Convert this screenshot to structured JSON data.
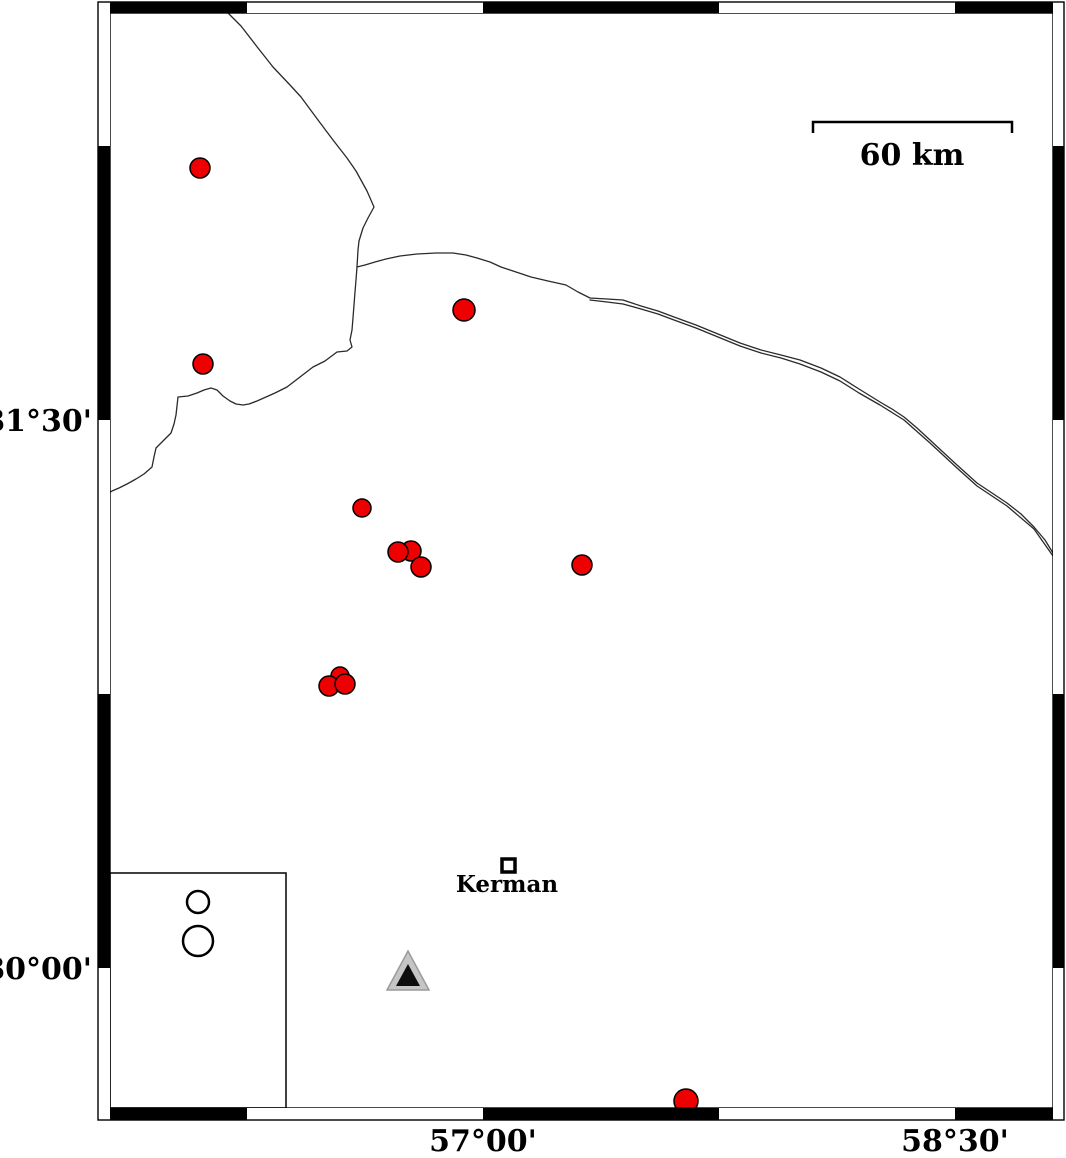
{
  "figure": {
    "type": "seismicity-map",
    "width": 1066,
    "height": 1158
  },
  "colors": {
    "epicenter_fill": "#ee0000",
    "marker_stroke": "#000000",
    "line": "#2a2a2a",
    "frame": "#000000",
    "triangle_fill": "#c5c5c5",
    "triangle_stroke": "#9a9a9a",
    "triangle_inner": "#0d0d0d",
    "background": "#ffffff"
  },
  "axis": {
    "lat_ticks": [
      {
        "label": "31°30'",
        "x": 92,
        "y": 431
      },
      {
        "label": "30°00'",
        "x": 92,
        "y": 979
      }
    ],
    "lon_ticks": [
      {
        "label": "57°00'",
        "x": 483,
        "y": 1151
      },
      {
        "label": "58°30'",
        "x": 955,
        "y": 1151
      }
    ]
  },
  "frame": {
    "outer": {
      "x": 98,
      "y": 2,
      "w": 966,
      "h": 1118
    },
    "inner": {
      "x": 110,
      "y": 13,
      "w": 943,
      "h": 1095
    },
    "segments": {
      "top": [
        [
          110,
          247
        ],
        [
          483,
          719
        ],
        [
          955,
          1053
        ]
      ],
      "bottom": [
        [
          110,
          247
        ],
        [
          483,
          719
        ],
        [
          955,
          1053
        ]
      ],
      "left": [
        [
          146,
          420
        ],
        [
          694,
          968
        ]
      ],
      "right": [
        [
          146,
          420
        ],
        [
          694,
          968
        ]
      ]
    }
  },
  "scalebar": {
    "label": "60 km",
    "x1": 813,
    "x2": 1012,
    "y": 122,
    "tick_bottom": 133,
    "label_x": 912,
    "label_y": 165
  },
  "city": {
    "name": "Kerman",
    "square": {
      "x": 502,
      "y": 859,
      "size": 13
    },
    "label_x": 507,
    "label_y": 892
  },
  "station_triangle": {
    "outer_points": "408,951 387,990 429,990",
    "inner_points": "408,964 396,986 420,986"
  },
  "legend": {
    "box": {
      "x": 110,
      "y": 873,
      "w": 176,
      "h": 235
    },
    "circles": [
      {
        "x": 198,
        "y": 902,
        "r": 11
      },
      {
        "x": 198,
        "y": 941,
        "r": 15
      }
    ]
  },
  "earthquakes": [
    {
      "x": 200,
      "y": 168,
      "r": 10
    },
    {
      "x": 203,
      "y": 364,
      "r": 10
    },
    {
      "x": 464,
      "y": 310,
      "r": 11
    },
    {
      "x": 362,
      "y": 508,
      "r": 9
    },
    {
      "x": 411,
      "y": 551,
      "r": 10
    },
    {
      "x": 398,
      "y": 552,
      "r": 10
    },
    {
      "x": 421,
      "y": 567,
      "r": 10
    },
    {
      "x": 582,
      "y": 565,
      "r": 10
    },
    {
      "x": 340,
      "y": 676,
      "r": 9
    },
    {
      "x": 329,
      "y": 686,
      "r": 10
    },
    {
      "x": 345,
      "y": 684,
      "r": 10
    },
    {
      "x": 686,
      "y": 1101,
      "r": 12
    }
  ],
  "map_lines": [
    {
      "name": "boundary-line-north",
      "points": [
        [
          228,
          13
        ],
        [
          241,
          26
        ],
        [
          258,
          48
        ],
        [
          273,
          67
        ],
        [
          290,
          85
        ],
        [
          301,
          97
        ],
        [
          318,
          120
        ],
        [
          333,
          140
        ],
        [
          347,
          158
        ],
        [
          356,
          171
        ],
        [
          367,
          191
        ],
        [
          374,
          207
        ],
        [
          368,
          218
        ],
        [
          363,
          228
        ],
        [
          359,
          241
        ],
        [
          358,
          250
        ],
        [
          357,
          267
        ]
      ]
    },
    {
      "name": "boundary-line-east",
      "points": [
        [
          357,
          267
        ],
        [
          365,
          265
        ],
        [
          375,
          262
        ],
        [
          386,
          259
        ],
        [
          400,
          256
        ],
        [
          417,
          254
        ],
        [
          436,
          253
        ],
        [
          453,
          253
        ],
        [
          466,
          255
        ],
        [
          477,
          258
        ],
        [
          490,
          262
        ],
        [
          501,
          267
        ],
        [
          516,
          272
        ],
        [
          531,
          277
        ],
        [
          548,
          281
        ],
        [
          566,
          285
        ],
        [
          578,
          292
        ],
        [
          590,
          298
        ],
        [
          607,
          299
        ],
        [
          623,
          300
        ],
        [
          641,
          306
        ],
        [
          658,
          311
        ],
        [
          674,
          317
        ],
        [
          696,
          325
        ],
        [
          718,
          334
        ],
        [
          740,
          343
        ],
        [
          761,
          350
        ],
        [
          781,
          355
        ],
        [
          800,
          360
        ],
        [
          821,
          368
        ],
        [
          840,
          377
        ],
        [
          859,
          389
        ],
        [
          880,
          402
        ],
        [
          892,
          409
        ],
        [
          904,
          417
        ],
        [
          917,
          428
        ],
        [
          930,
          440
        ],
        [
          944,
          453
        ],
        [
          957,
          465
        ],
        [
          967,
          474
        ],
        [
          977,
          483
        ],
        [
          992,
          493
        ],
        [
          1007,
          503
        ],
        [
          1021,
          514
        ],
        [
          1034,
          527
        ],
        [
          1045,
          540
        ],
        [
          1053,
          553
        ]
      ]
    },
    {
      "name": "boundary-line-east-second-strand",
      "points": [
        [
          590,
          300
        ],
        [
          607,
          302
        ],
        [
          623,
          304
        ],
        [
          641,
          309
        ],
        [
          658,
          314
        ],
        [
          674,
          320
        ],
        [
          696,
          328
        ],
        [
          718,
          337
        ],
        [
          740,
          346
        ],
        [
          761,
          353
        ],
        [
          781,
          358
        ],
        [
          800,
          364
        ],
        [
          821,
          372
        ],
        [
          840,
          381
        ],
        [
          859,
          393
        ],
        [
          880,
          405
        ],
        [
          904,
          420
        ],
        [
          930,
          443
        ],
        [
          957,
          468
        ],
        [
          977,
          486
        ],
        [
          1007,
          506
        ],
        [
          1034,
          529
        ],
        [
          1053,
          556
        ]
      ]
    },
    {
      "name": "boundary-line-southwest",
      "points": [
        [
          357,
          267
        ],
        [
          356,
          280
        ],
        [
          355,
          292
        ],
        [
          354,
          305
        ],
        [
          353,
          318
        ],
        [
          352,
          330
        ],
        [
          350,
          340
        ],
        [
          352,
          347
        ],
        [
          347,
          351
        ],
        [
          337,
          352
        ],
        [
          325,
          361
        ],
        [
          313,
          367
        ],
        [
          300,
          377
        ],
        [
          287,
          387
        ],
        [
          275,
          393
        ],
        [
          266,
          397
        ],
        [
          257,
          401
        ],
        [
          249,
          404
        ],
        [
          243,
          405
        ],
        [
          236,
          404
        ],
        [
          230,
          401
        ],
        [
          223,
          396
        ],
        [
          217,
          390
        ],
        [
          211,
          388
        ],
        [
          204,
          390
        ],
        [
          197,
          393
        ],
        [
          188,
          396
        ],
        [
          178,
          397
        ],
        [
          177,
          406
        ],
        [
          176,
          415
        ],
        [
          174,
          424
        ],
        [
          171,
          433
        ],
        [
          163,
          441
        ],
        [
          156,
          448
        ],
        [
          154,
          457
        ],
        [
          152,
          467
        ],
        [
          144,
          474
        ],
        [
          136,
          479
        ],
        [
          127,
          484
        ],
        [
          119,
          488
        ],
        [
          112,
          491
        ],
        [
          109,
          493
        ]
      ]
    }
  ]
}
